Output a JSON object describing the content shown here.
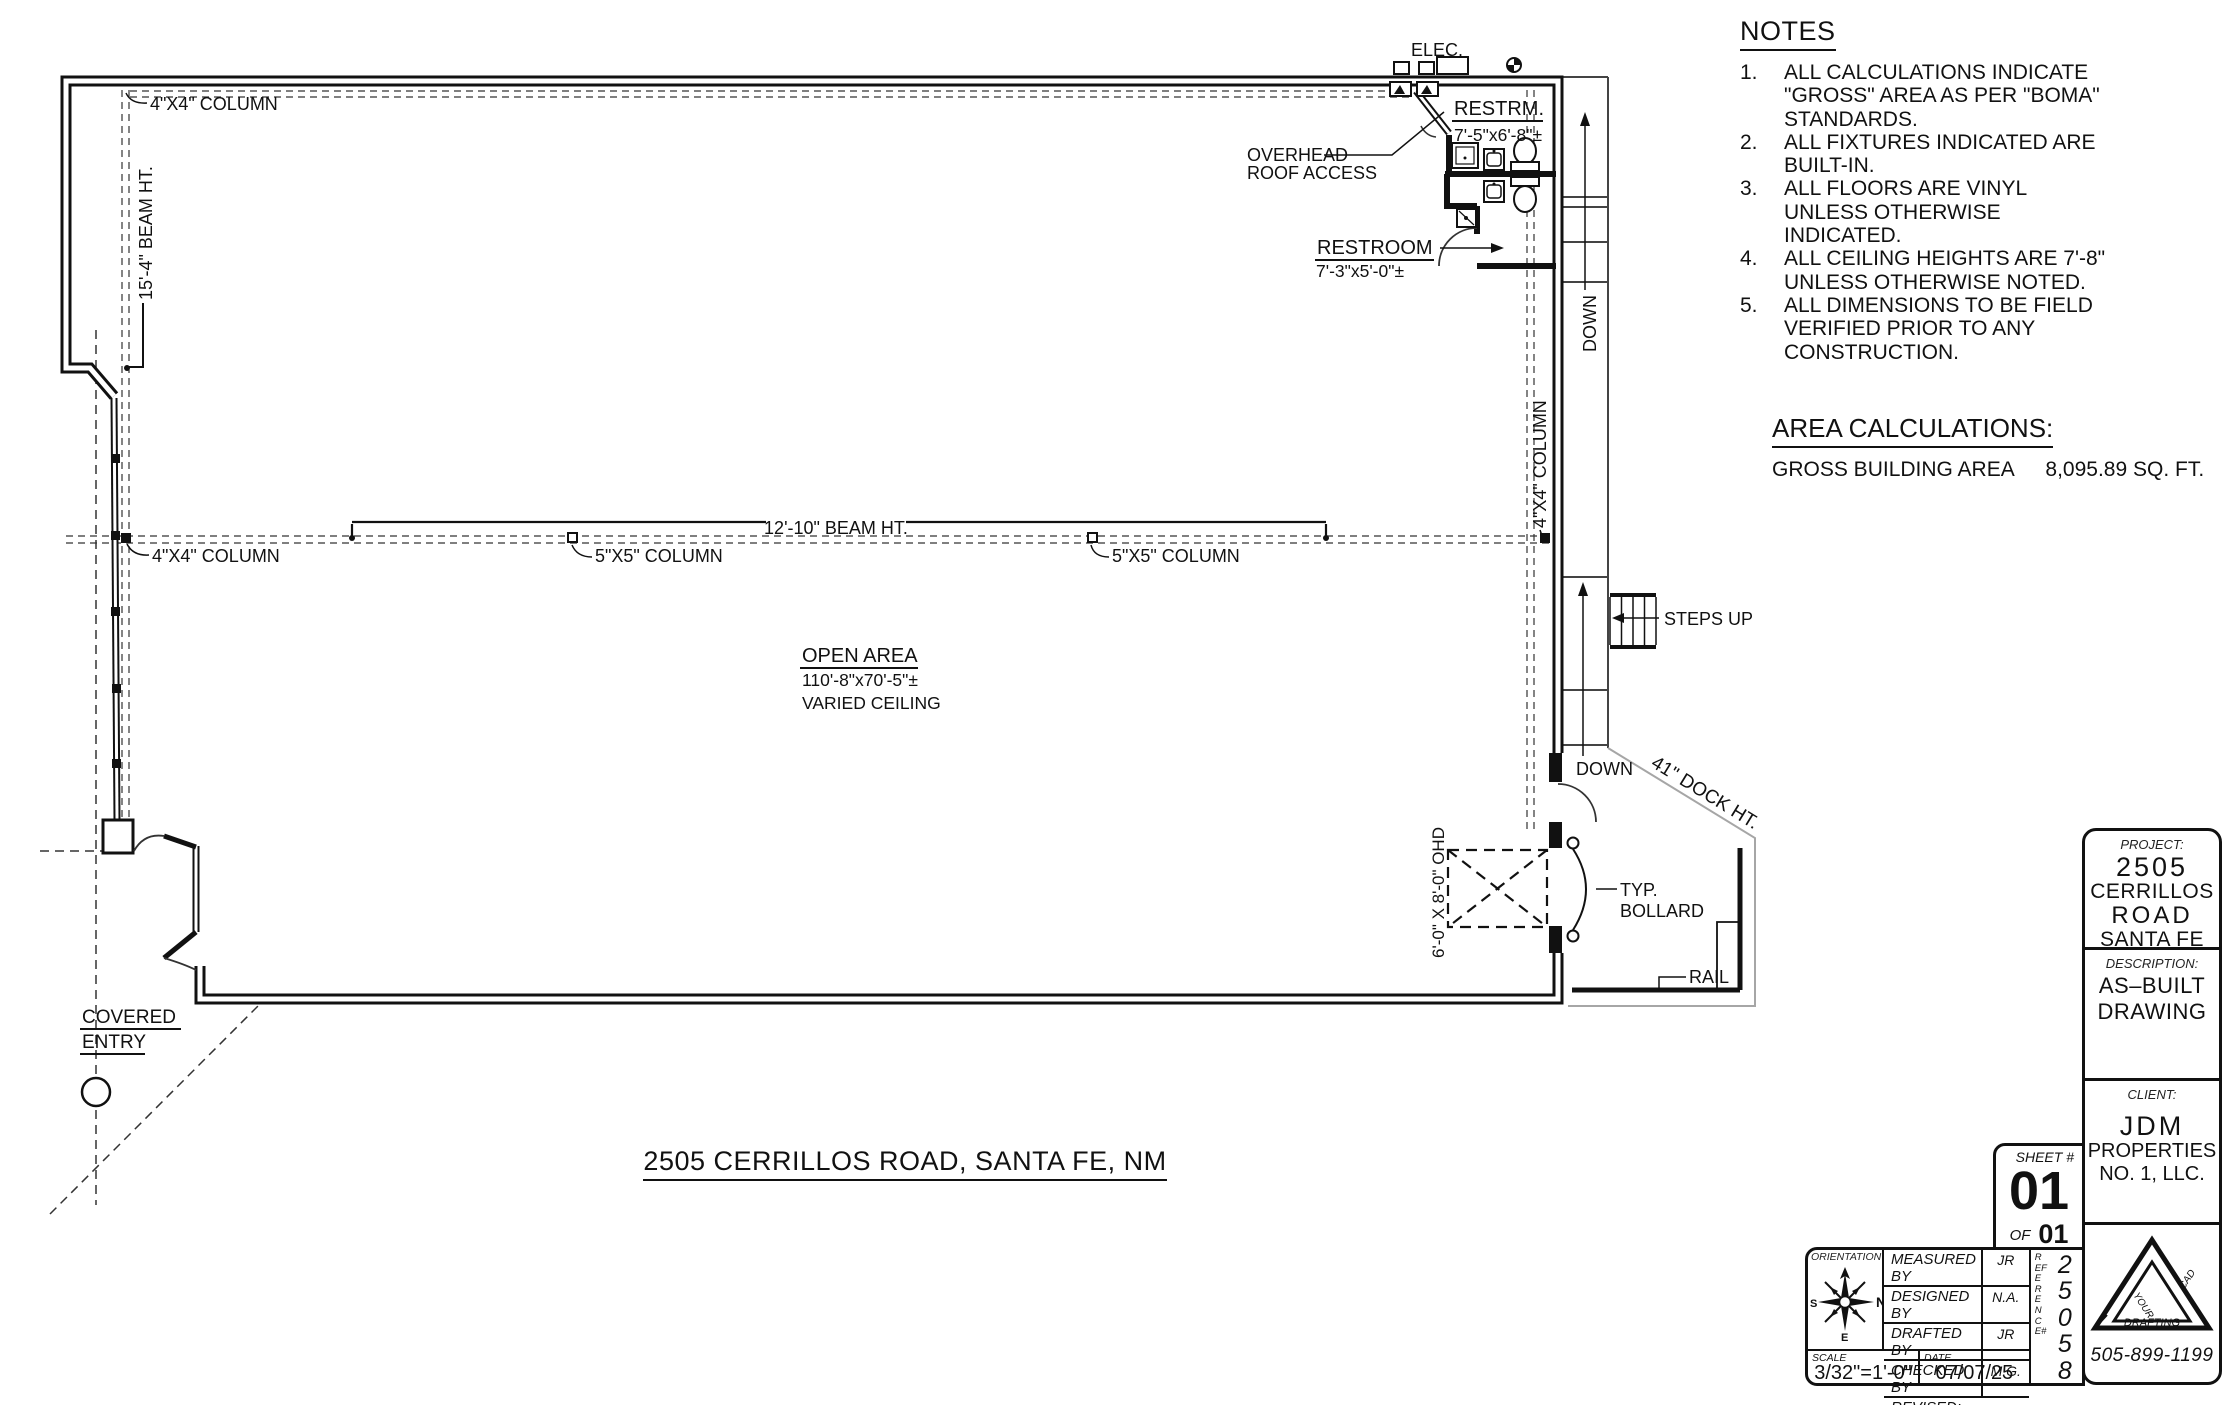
{
  "plan": {
    "labels": {
      "col_4x4_top": "4\"X4\" COLUMN",
      "beam_15_4": "15'-4\" BEAM HT.",
      "elec": "ELEC.",
      "restrm_title": "RESTRM.",
      "restrm_dims": "7'-5\"x6'-8\"±",
      "overhead_1": "OVERHEAD",
      "overhead_2": "ROOF ACCESS",
      "restroom_title": "RESTROOM",
      "restroom_dims": "7'-3\"x5'-0\"±",
      "down_upper": "DOWN",
      "down_lower": "DOWN",
      "col_4x4_right": "4\"X4\" COLUMN",
      "beam_12_10": "12'-10\" BEAM HT.",
      "col_4x4_left": "4\"X4\" COLUMN",
      "col_5x5_a": "5\"X5\" COLUMN",
      "col_5x5_b": "5\"X5\" COLUMN",
      "open_area_title": "OPEN AREA",
      "open_area_dims": "110'-8\"x70'-5\"±",
      "open_area_note": "VARIED CEILING",
      "steps_up": "STEPS UP",
      "dock_ht": "41\" DOCK HT.",
      "ohd": "6'-0\" X 8'-0\" OHD",
      "typ_bollard_1": "TYP.",
      "typ_bollard_2": "BOLLARD",
      "rail": "RAIL",
      "covered_1": "COVERED",
      "covered_2": "ENTRY"
    },
    "address": "2505 CERRILLOS ROAD, SANTA FE, NM"
  },
  "notes": {
    "title": "NOTES",
    "numbers": [
      "1.",
      "2.",
      "3.",
      "4.",
      "5."
    ],
    "items": [
      "ALL CALCULATIONS INDICATE \"GROSS\" AREA AS PER \"BOMA\" STANDARDS.",
      "ALL FIXTURES INDICATED ARE BUILT-IN.",
      "ALL FLOORS ARE VINYL UNLESS OTHERWISE INDICATED.",
      "ALL CEILING HEIGHTS ARE 7'-8\" UNLESS OTHERWISE NOTED.",
      "ALL DIMENSIONS TO BE FIELD VERIFIED PRIOR TO ANY CONSTRUCTION."
    ]
  },
  "area_calc": {
    "title": "AREA CALCULATIONS:",
    "label": "GROSS BUILDING AREA",
    "value": "8,095.89 SQ. FT."
  },
  "titleblock": {
    "project_label": "PROJECT:",
    "project_lines": [
      "2505",
      "CERRILLOS",
      "ROAD",
      "SANTA FE"
    ],
    "description_label": "DESCRIPTION:",
    "description_lines": [
      "AS–BUILT",
      "DRAWING"
    ],
    "client_label": "CLIENT:",
    "client_lines": [
      "JDM",
      "PROPERTIES",
      "NO. 1, LLC."
    ],
    "sheet_label": "SHEET #",
    "sheet_number": "01",
    "of_label": "OF",
    "of_number": "01",
    "orientation_label": "ORIENTATION",
    "compass": {
      "n": "N",
      "s": "S",
      "e": "E"
    },
    "credits": [
      {
        "label": "MEASURED BY",
        "value": "JR"
      },
      {
        "label": "DESIGNED BY",
        "value": "N.A."
      },
      {
        "label": "DRAFTED BY",
        "value": "JR"
      },
      {
        "label": "CHECKED BY",
        "value": "M.G."
      }
    ],
    "revised_label": "REVISED:",
    "scale_label": "SCALE",
    "scale_value": "3/32\"=1'-0\"",
    "date_label": "DATE",
    "date_value": "07/07/25",
    "reference_label": "REFERENCE#",
    "reference_digits": [
      "2",
      "5",
      "0",
      "5",
      "8"
    ],
    "logo_words": [
      "YOUR",
      "CAD",
      "DRAFTING"
    ],
    "phone": "505-899-1199"
  },
  "colors": {
    "ink": "#111111",
    "paper": "#ffffff",
    "dock_gray": "#a6a6a6"
  }
}
